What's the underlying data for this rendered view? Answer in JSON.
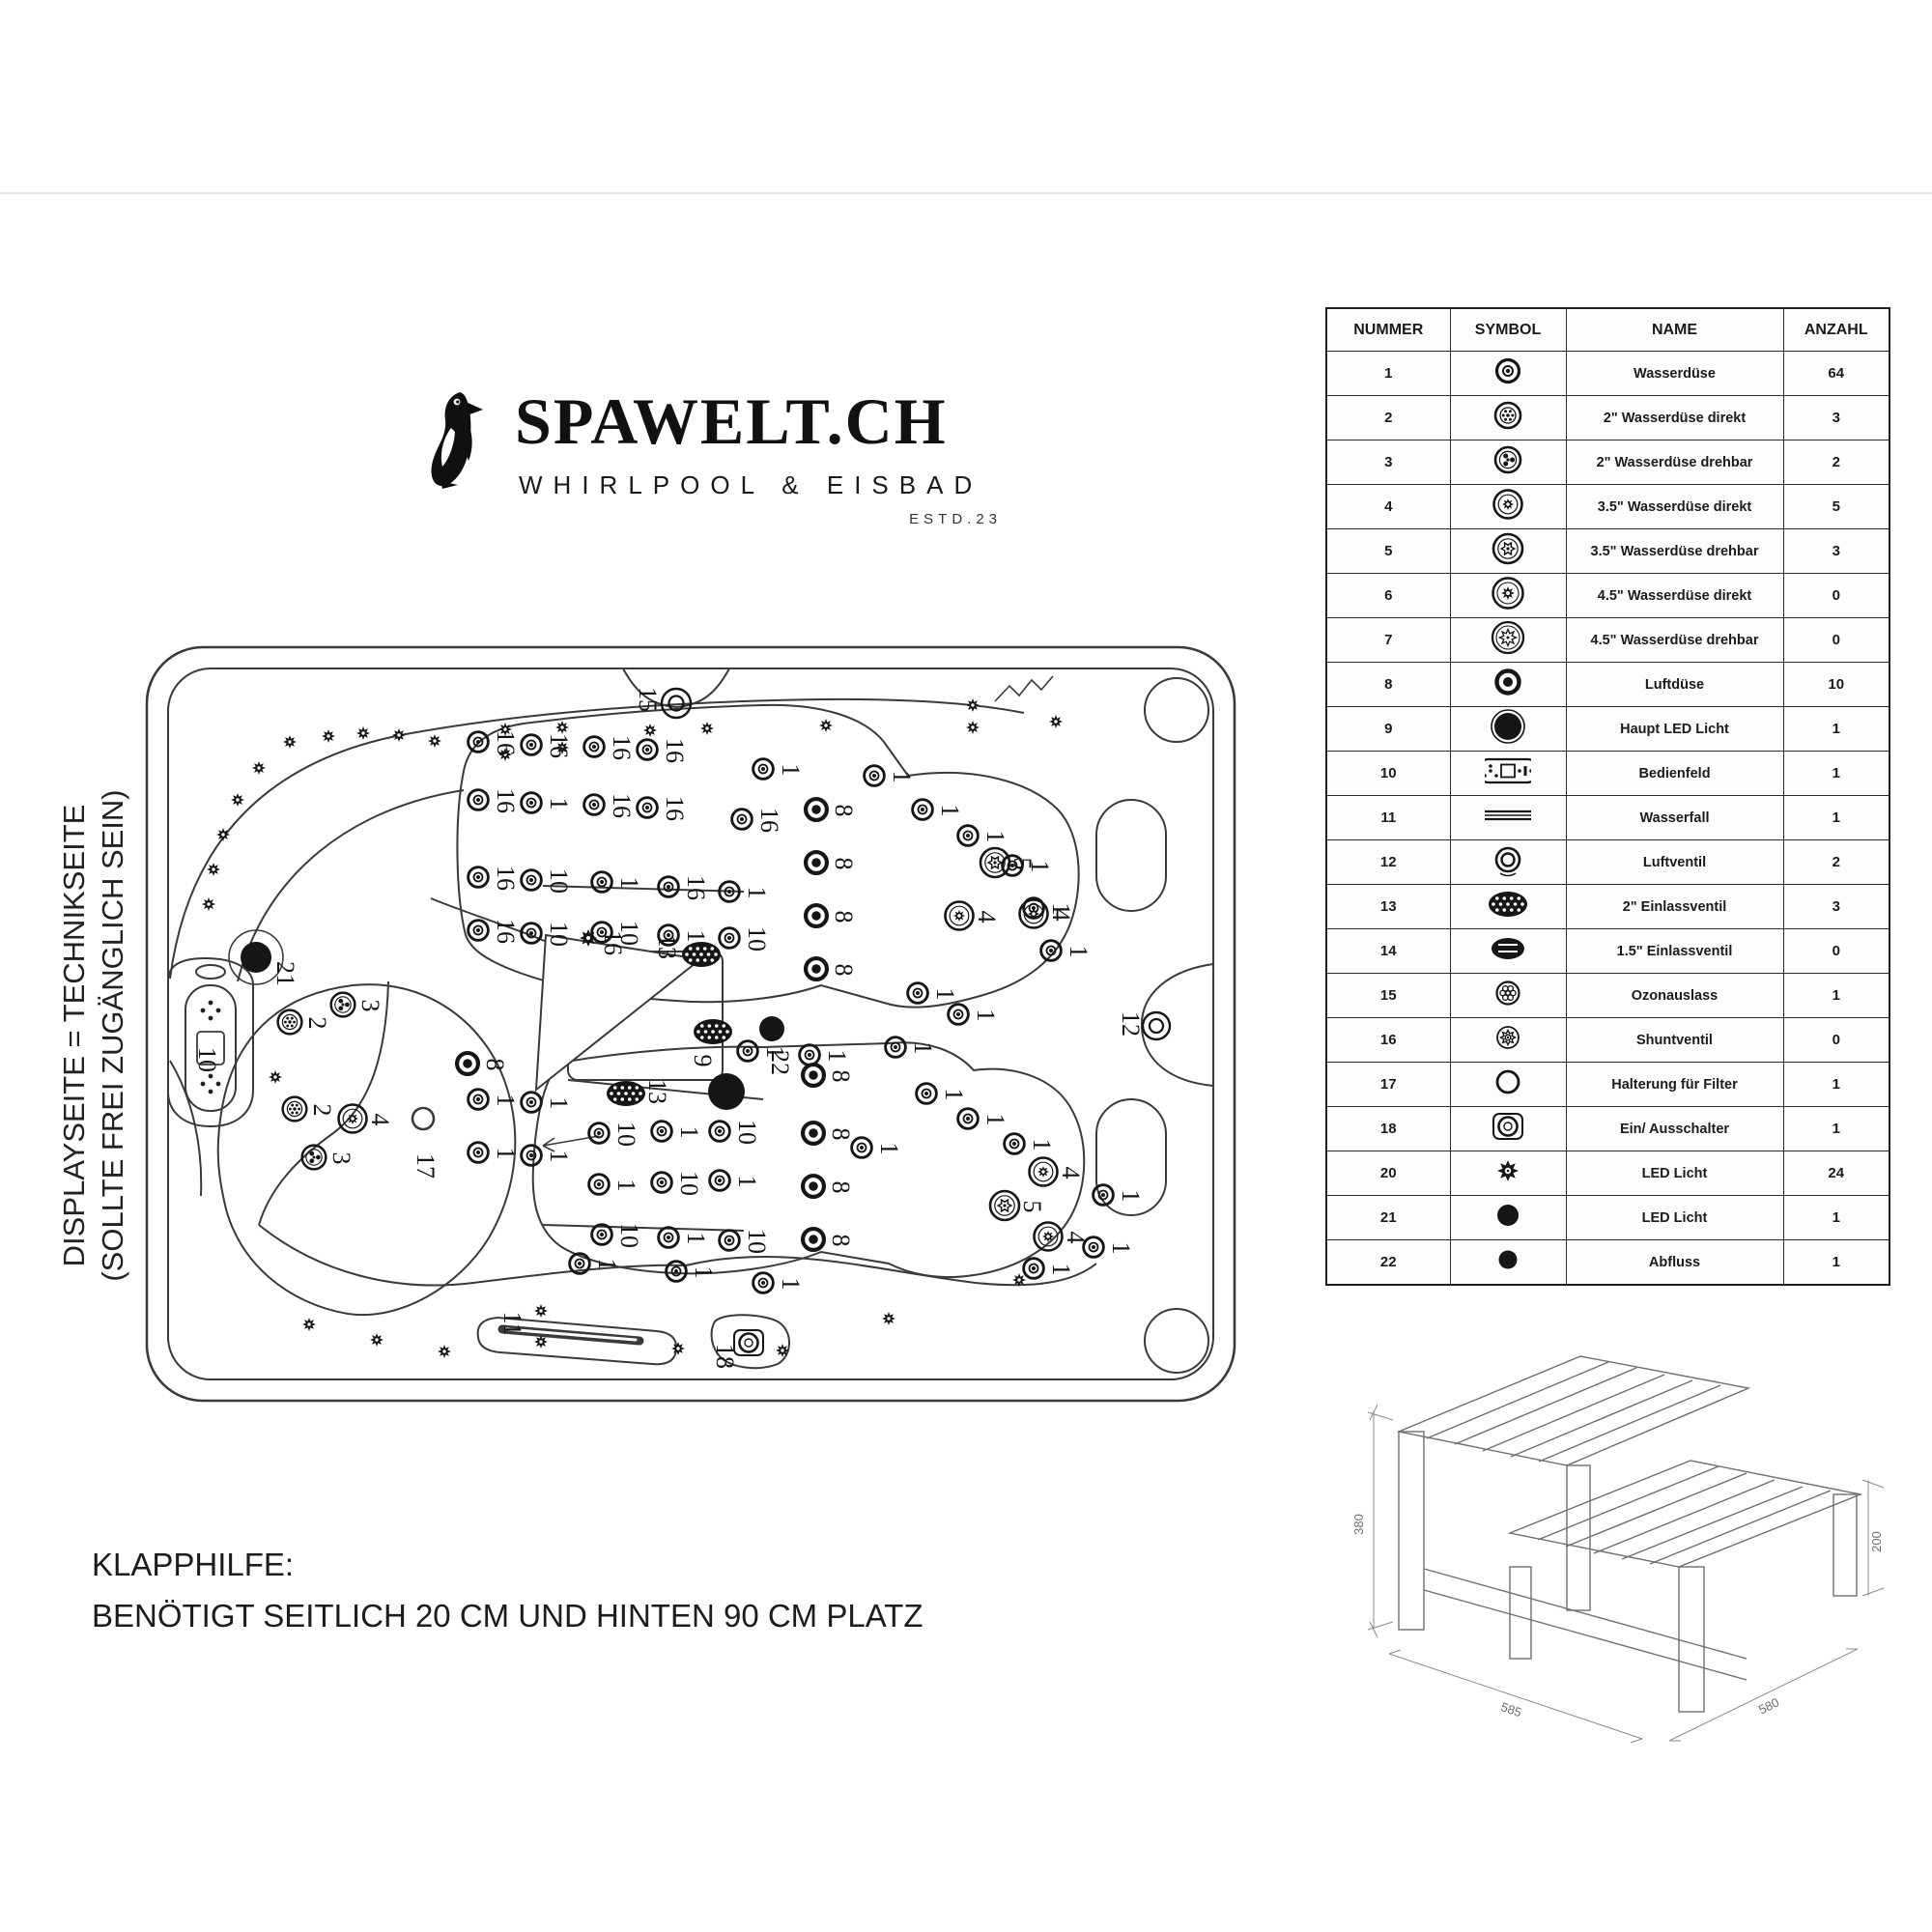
{
  "logo": {
    "brand": "SPAWELT.CH",
    "tagline": "WHIRLPOOL & EISBAD",
    "estd": "ESTD.23",
    "icon": "penguin-icon"
  },
  "side_note": {
    "line1": "DISPLAYSEITE = TECHNIKSEITE",
    "line2": "(SOLLTE FREI ZUGÄNGLICH SEIN)"
  },
  "bottom_note": {
    "line1": "KLAPPHILFE:",
    "line2": "BENÖTIGT SEITLICH 20 CM UND HINTEN 90 CM PLATZ"
  },
  "parts_table": {
    "headers": [
      "NUMMER",
      "SYMBOL",
      "NAME",
      "ANZAHL"
    ],
    "rows": [
      {
        "nummer": "1",
        "symbol": "jet-water-icon",
        "name": "Wasserdüse",
        "anzahl": "64"
      },
      {
        "nummer": "2",
        "symbol": "jet-2in-direct-icon",
        "name": "2\" Wasserdüse direkt",
        "anzahl": "3"
      },
      {
        "nummer": "3",
        "symbol": "jet-2in-rotate-icon",
        "name": "2\" Wasserdüse drehbar",
        "anzahl": "2"
      },
      {
        "nummer": "4",
        "symbol": "jet-35in-direct-icon",
        "name": "3.5\" Wasserdüse direkt",
        "anzahl": "5"
      },
      {
        "nummer": "5",
        "symbol": "jet-35in-rotate-icon",
        "name": "3.5\" Wasserdüse drehbar",
        "anzahl": "3"
      },
      {
        "nummer": "6",
        "symbol": "jet-45in-direct-icon",
        "name": "4.5\" Wasserdüse direkt",
        "anzahl": "0"
      },
      {
        "nummer": "7",
        "symbol": "jet-45in-rotate-icon",
        "name": "4.5\" Wasserdüse drehbar",
        "anzahl": "0"
      },
      {
        "nummer": "8",
        "symbol": "air-jet-icon",
        "name": "Luftdüse",
        "anzahl": "10"
      },
      {
        "nummer": "9",
        "symbol": "main-led-icon",
        "name": "Haupt LED Licht",
        "anzahl": "1"
      },
      {
        "nummer": "10",
        "symbol": "control-panel-icon",
        "name": "Bedienfeld",
        "anzahl": "1"
      },
      {
        "nummer": "11",
        "symbol": "waterfall-icon",
        "name": "Wasserfall",
        "anzahl": "1"
      },
      {
        "nummer": "12",
        "symbol": "air-valve-icon",
        "name": "Luftventil",
        "anzahl": "2"
      },
      {
        "nummer": "13",
        "symbol": "inlet-2in-icon",
        "name": "2\" Einlassventil",
        "anzahl": "3"
      },
      {
        "nummer": "14",
        "symbol": "inlet-15in-icon",
        "name": "1.5\" Einlassventil",
        "anzahl": "0"
      },
      {
        "nummer": "15",
        "symbol": "ozone-cluster-icon",
        "name": "Ozonauslass",
        "anzahl": "1"
      },
      {
        "nummer": "16",
        "symbol": "shunt-valve-icon",
        "name": "Shuntventil",
        "anzahl": "0"
      },
      {
        "nummer": "17",
        "symbol": "filter-holder-icon",
        "name": "Halterung für Filter",
        "anzahl": "1"
      },
      {
        "nummer": "18",
        "symbol": "on-off-switch-icon",
        "name": "Ein/ Ausschalter",
        "anzahl": "1"
      },
      {
        "nummer": "20",
        "symbol": "led-light-icon",
        "name": "LED Licht",
        "anzahl": "24"
      },
      {
        "nummer": "21",
        "symbol": "led-round-icon",
        "name": "LED Licht",
        "anzahl": "1"
      },
      {
        "nummer": "22",
        "symbol": "drain-icon",
        "name": "Abfluss",
        "anzahl": "1"
      }
    ]
  },
  "diagram": {
    "jets": [
      [
        150,
        100,
        "flower-jet"
      ],
      [
        118,
        127,
        "flower-jet"
      ],
      [
        96,
        160,
        "flower-jet"
      ],
      [
        81,
        196,
        "flower-jet"
      ],
      [
        71,
        232,
        "flower-jet"
      ],
      [
        66,
        268,
        "flower-jet"
      ],
      [
        190,
        94,
        "flower-jet"
      ],
      [
        226,
        91,
        "flower-jet"
      ],
      [
        263,
        93,
        "flower-jet"
      ],
      [
        300,
        99,
        "flower-jet"
      ],
      [
        373,
        87,
        "flower-jet"
      ],
      [
        373,
        113,
        "flower-jet"
      ],
      [
        432,
        85,
        "flower-jet"
      ],
      [
        432,
        106,
        "flower-jet"
      ],
      [
        523,
        88,
        "flower-jet"
      ],
      [
        582,
        86,
        "flower-jet"
      ],
      [
        705,
        83,
        "flower-jet"
      ],
      [
        857,
        62,
        "flower-jet"
      ],
      [
        857,
        85,
        "flower-jet"
      ],
      [
        943,
        79,
        "flower-jet"
      ],
      [
        170,
        703,
        "flower-jet"
      ],
      [
        240,
        719,
        "flower-jet"
      ],
      [
        310,
        731,
        "flower-jet"
      ],
      [
        410,
        689,
        "flower-jet"
      ],
      [
        410,
        721,
        "flower-jet"
      ],
      [
        552,
        728,
        "flower-jet"
      ],
      [
        660,
        730,
        "flower-jet"
      ],
      [
        770,
        697,
        "flower-jet"
      ],
      [
        905,
        657,
        "flower-jet"
      ],
      [
        135,
        447,
        "flower-jet"
      ],
      [
        345,
        100,
        "water-jet",
        "16"
      ],
      [
        400,
        103,
        "water-jet",
        "16"
      ],
      [
        345,
        160,
        "water-jet",
        "16"
      ],
      [
        400,
        163,
        "water-jet",
        "1"
      ],
      [
        465,
        105,
        "water-jet",
        "16"
      ],
      [
        520,
        108,
        "water-jet",
        "16"
      ],
      [
        465,
        165,
        "water-jet",
        "16"
      ],
      [
        520,
        168,
        "water-jet",
        "16"
      ],
      [
        345,
        240,
        "water-jet",
        "16"
      ],
      [
        400,
        243,
        "water-jet",
        "10"
      ],
      [
        345,
        295,
        "water-jet",
        "16"
      ],
      [
        400,
        298,
        "water-jet",
        "10"
      ],
      [
        473,
        245,
        "water-jet",
        "1"
      ],
      [
        542,
        250,
        "water-jet",
        "16"
      ],
      [
        605,
        255,
        "water-jet",
        "1"
      ],
      [
        473,
        297,
        "water-jet",
        "10"
      ],
      [
        542,
        300,
        "water-jet",
        "1"
      ],
      [
        605,
        303,
        "water-jet",
        "10"
      ],
      [
        640,
        128,
        "water-jet",
        "1"
      ],
      [
        618,
        180,
        "water-jet",
        "16"
      ],
      [
        755,
        135,
        "water-jet",
        "1"
      ],
      [
        805,
        170,
        "water-jet",
        "1"
      ],
      [
        852,
        197,
        "water-jet",
        "1"
      ],
      [
        898,
        228,
        "water-jet",
        "1"
      ],
      [
        920,
        272,
        "water-jet",
        "1"
      ],
      [
        938,
        316,
        "water-jet",
        "1"
      ],
      [
        800,
        360,
        "water-jet",
        "1"
      ],
      [
        842,
        382,
        "water-jet",
        "1"
      ],
      [
        624,
        420,
        "water-jet",
        "1"
      ],
      [
        688,
        424,
        "water-jet",
        "1"
      ],
      [
        777,
        416,
        "water-jet",
        "1"
      ],
      [
        345,
        470,
        "water-jet",
        "1"
      ],
      [
        400,
        473,
        "water-jet",
        "1"
      ],
      [
        345,
        525,
        "water-jet",
        "1"
      ],
      [
        400,
        528,
        "water-jet",
        "1"
      ],
      [
        470,
        505,
        "water-jet",
        "10"
      ],
      [
        535,
        503,
        "water-jet",
        "1"
      ],
      [
        595,
        503,
        "water-jet",
        "10"
      ],
      [
        470,
        558,
        "water-jet",
        "1"
      ],
      [
        535,
        556,
        "water-jet",
        "10"
      ],
      [
        595,
        554,
        "water-jet",
        "1"
      ],
      [
        473,
        610,
        "water-jet",
        "10"
      ],
      [
        542,
        613,
        "water-jet",
        "1"
      ],
      [
        605,
        616,
        "water-jet",
        "10"
      ],
      [
        450,
        640,
        "water-jet",
        "1"
      ],
      [
        550,
        648,
        "water-jet",
        "1"
      ],
      [
        640,
        660,
        "water-jet",
        "1"
      ],
      [
        742,
        520,
        "water-jet",
        "1"
      ],
      [
        809,
        464,
        "water-jet",
        "1"
      ],
      [
        852,
        490,
        "water-jet",
        "1"
      ],
      [
        900,
        516,
        "water-jet",
        "1"
      ],
      [
        992,
        569,
        "water-jet",
        "1"
      ],
      [
        982,
        623,
        "water-jet",
        "1"
      ],
      [
        920,
        645,
        "water-jet",
        "1"
      ],
      [
        695,
        170,
        "air-jet",
        "8"
      ],
      [
        695,
        225,
        "air-jet",
        "8"
      ],
      [
        695,
        280,
        "air-jet",
        "8"
      ],
      [
        695,
        335,
        "air-jet",
        "8"
      ],
      [
        692,
        445,
        "air-jet",
        "8"
      ],
      [
        692,
        505,
        "air-jet",
        "8"
      ],
      [
        692,
        560,
        "air-jet",
        "8"
      ],
      [
        692,
        615,
        "air-jet",
        "8"
      ],
      [
        334,
        433,
        "air-jet",
        "8"
      ],
      [
        880,
        225,
        "jet-35-rotate",
        "5"
      ],
      [
        843,
        280,
        "jet-35-direct",
        "4"
      ],
      [
        920,
        278,
        "jet-35-direct",
        "4"
      ],
      [
        890,
        580,
        "jet-35-rotate",
        "5"
      ],
      [
        930,
        545,
        "jet-35-direct",
        "4"
      ],
      [
        935,
        612,
        "jet-35-direct",
        "4"
      ],
      [
        205,
        372,
        "jet-2-rotate",
        "3"
      ],
      [
        150,
        390,
        "jet-2-direct",
        "2"
      ],
      [
        155,
        480,
        "jet-2-direct",
        "2"
      ],
      [
        215,
        490,
        "jet-35-direct",
        "4"
      ],
      [
        175,
        530,
        "jet-2-rotate",
        "3"
      ],
      [
        115,
        323,
        "led21",
        "21",
        143,
        340
      ],
      [
        602,
        462,
        "led9",
        "9",
        575,
        430
      ],
      [
        649,
        397,
        "led22",
        "22",
        655,
        432
      ],
      [
        576,
        320,
        "inlet-valve",
        "13",
        538,
        312
      ],
      [
        588,
        400,
        "inlet-valve",
        ""
      ],
      [
        498,
        464,
        "inlet-valve",
        "13",
        528,
        462
      ],
      [
        459,
        303,
        "ozone-gear",
        "16",
        482,
        308
      ],
      [
        1047,
        394,
        "air-valve",
        "12",
        1018,
        392
      ],
      [
        550,
        60,
        "air-valve-top",
        "15",
        518,
        56
      ],
      [
        625,
        722,
        "on-off-switch",
        "18",
        598,
        736
      ],
      [
        288,
        490,
        "filter-ring",
        ""
      ],
      [
        36,
        428,
        "label",
        "10"
      ],
      [
        352,
        701,
        "label",
        "11"
      ],
      [
        262,
        538,
        "label",
        "17"
      ]
    ],
    "step_stool": {
      "height": "380",
      "step_height": "200",
      "depth": "585",
      "width": "580"
    }
  }
}
